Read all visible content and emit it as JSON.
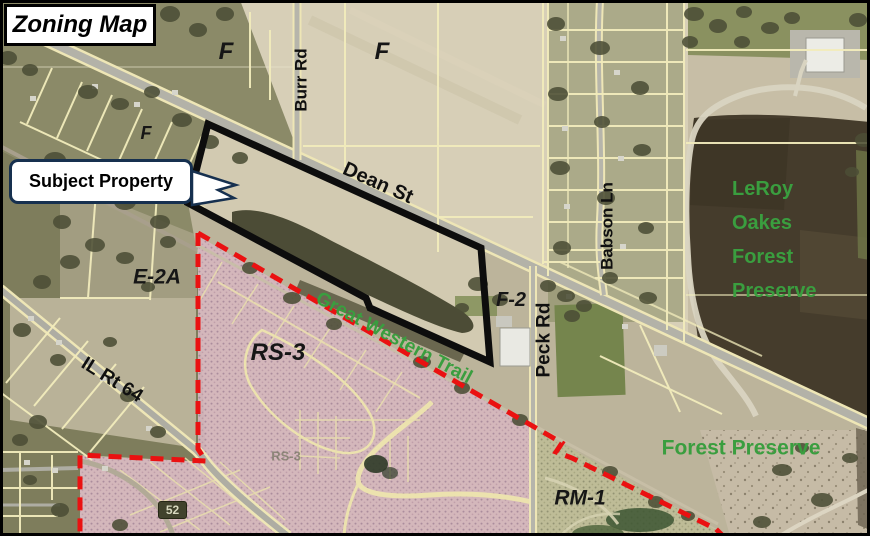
{
  "title": "Zoning Map",
  "callout": {
    "label": "Subject Property"
  },
  "zone_labels": {
    "f_nw": "F",
    "f_n": "F",
    "f_w": "F",
    "e2a": "E-2A",
    "f2": "F-2",
    "rs3": "RS-3",
    "rs3_faded": "RS-3",
    "rm1": "RM-1"
  },
  "road_labels": {
    "burr_rd": "Burr Rd",
    "dean_st": "Dean St",
    "babson_ln": "Babson Ln",
    "peck_rd": "Peck Rd",
    "il_rt_64": "IL Rt 64"
  },
  "green_labels": {
    "great_western_trail": "Great Western Trail",
    "forest_preserve": "Forest Preserve",
    "leroy_lines": [
      "LeRoy",
      "Oakes",
      "Forest",
      "Preserve"
    ]
  },
  "markers": {
    "route_52": "52"
  },
  "colors": {
    "boundary_dashed_red": "#ea1111",
    "subject_property_outline": "#0d0d0d",
    "zone_text_green": "#3a9e3f",
    "parcel_line_yellow": "#f2ecbc",
    "rs3_overlay_pink": "#d5b6bd",
    "callout_border_navy": "#16304f",
    "aerial_field_tan": "#d7cfb7"
  }
}
